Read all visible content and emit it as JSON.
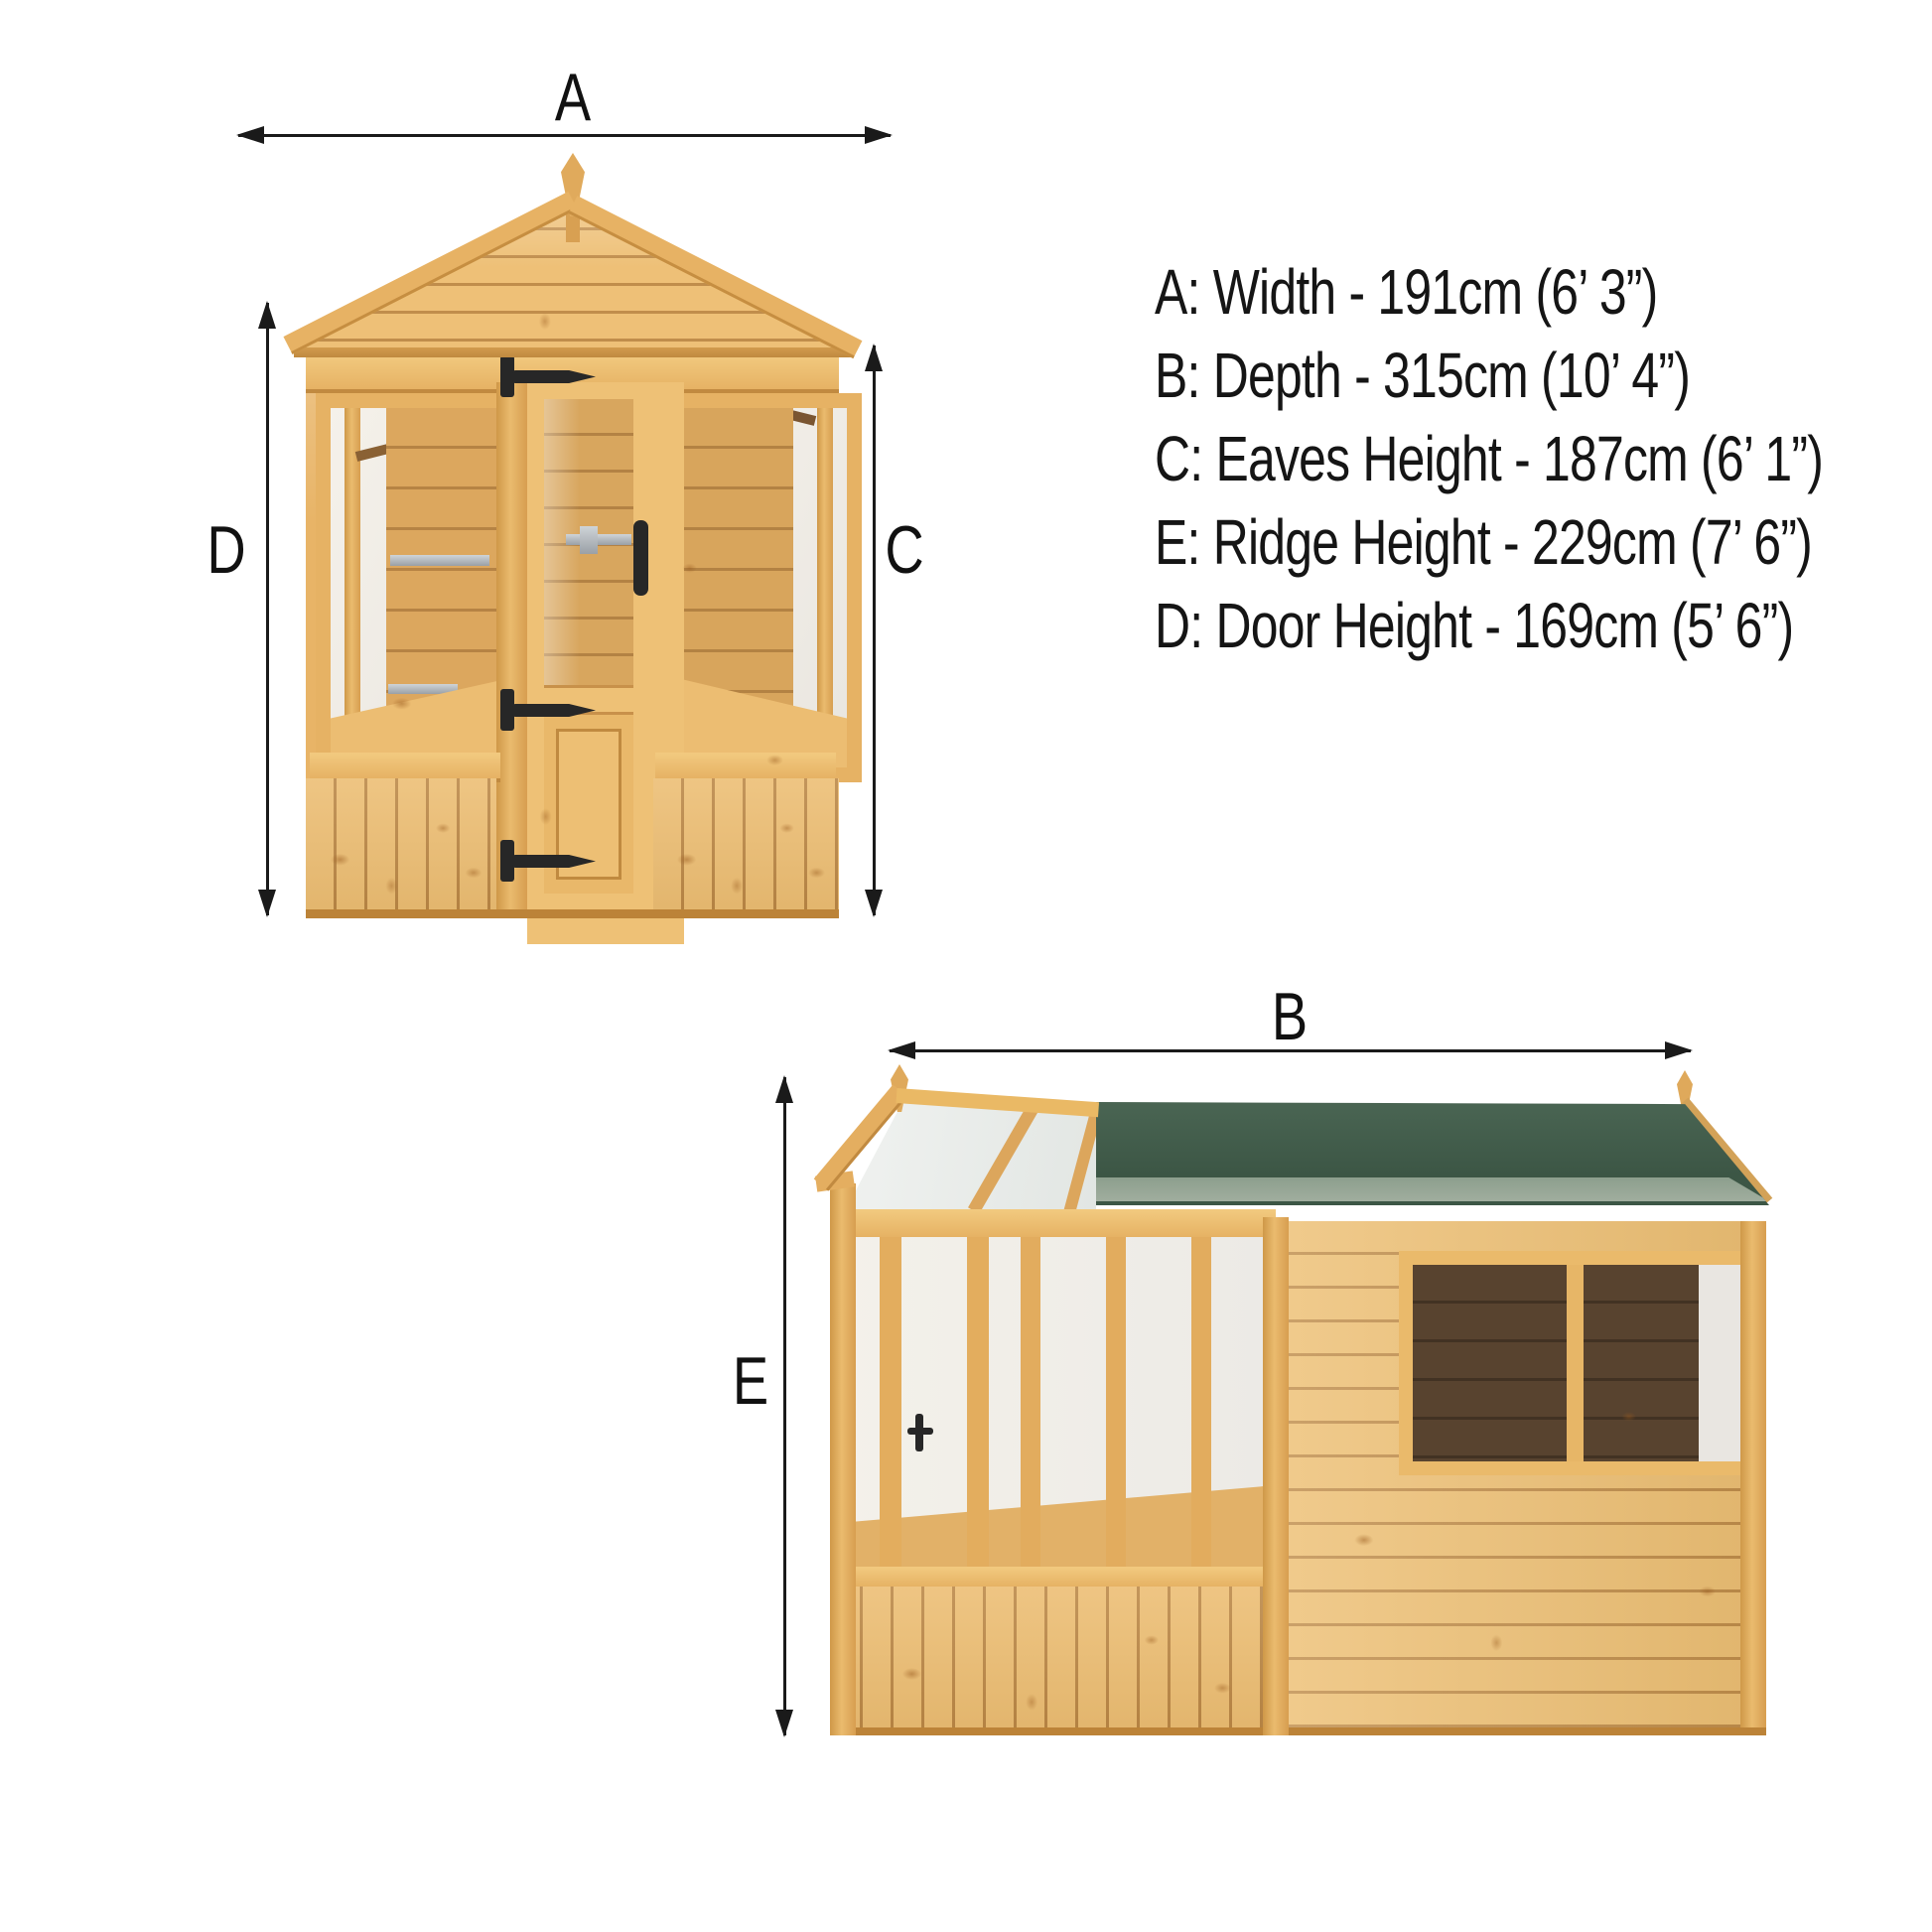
{
  "specs": {
    "lines": [
      "A: Width - 191cm (6’ 3”)",
      "B: Depth - 315cm (10’ 4”)",
      "C: Eaves Height - 187cm (6’ 1”)",
      "E: Ridge Height - 229cm (7’ 6”)",
      "D: Door Height - 169cm (5’ 6”)"
    ]
  },
  "front_view": {
    "width_label": "A",
    "door_height_label": "D",
    "eaves_height_label": "C"
  },
  "side_view": {
    "depth_label": "B",
    "ridge_height_label": "E"
  },
  "colors": {
    "wood_light": "#eebf76",
    "wood_mid": "#e3ad5e",
    "wood_dark": "#c18a40",
    "roof_felt_green": "#44604e",
    "roof_gravel_edge": "#9fae9f",
    "interior_dark": "#58432f",
    "glass_light": "#f3efe8",
    "hardware_black": "#2a2a2a",
    "hardware_silver": "#aab0b5",
    "dimension_line": "#1a1a1a"
  }
}
